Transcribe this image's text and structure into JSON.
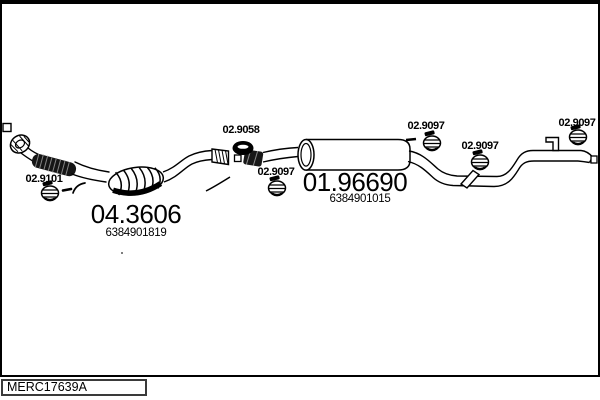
{
  "colors": {
    "line": "#000000",
    "background": "#ffffff"
  },
  "reference": {
    "code": "MERC17639A"
  },
  "assemblies": {
    "catalyst": {
      "number": "04.3606",
      "oe_number": "6384901819"
    },
    "rear_silencer": {
      "number": "01.96690",
      "oe_number": "6384901015"
    }
  },
  "fittings": {
    "front_clamp": {
      "code": "02.9101",
      "type": "clamp"
    },
    "gasket": {
      "code": "02.9058",
      "type": "gasket"
    },
    "mid_clamp": {
      "code": "02.9097",
      "type": "clamp"
    },
    "hanger_front": {
      "code": "02.9097",
      "type": "rubber-hanger"
    },
    "hanger_mid": {
      "code": "02.9097",
      "type": "rubber-hanger"
    },
    "hanger_rear": {
      "code": "02.9097",
      "type": "rubber-hanger"
    }
  }
}
